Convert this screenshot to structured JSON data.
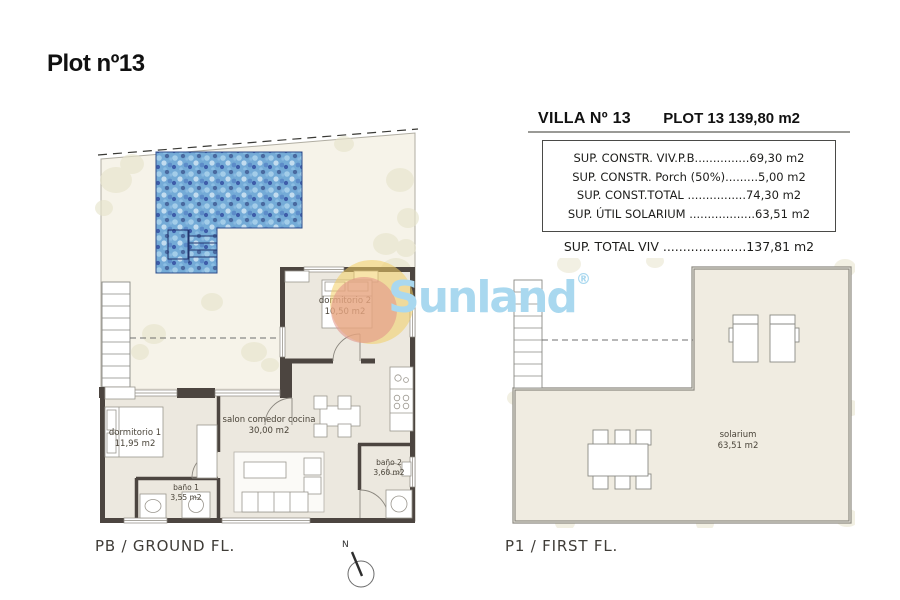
{
  "page": {
    "title": "Plot nº13"
  },
  "watermark": {
    "brand": "Sunland",
    "registered_mark": "®"
  },
  "spec_table": {
    "title_left": "VILLA Nº 13",
    "title_right": "PLOT 13 139,80 m2",
    "rows": [
      "SUP. CONSTR. VIV.P.B...............69,30 m2",
      "SUP. CONSTR. Porch (50%).........5,00 m2",
      "SUP. CONST.TOTAL ................74,30 m2",
      "SUP. ÚTIL SOLARIUM ..................63,51 m2"
    ],
    "total_row": "SUP. TOTAL VIV .....................137,81 m2"
  },
  "ground_floor": {
    "caption": "PB / GROUND FL.",
    "rooms": {
      "dormitorio2": {
        "name": "dormitorio 2",
        "area": "10,50 m2"
      },
      "dormitorio1": {
        "name": "dormitorio 1",
        "area": "11,95 m2"
      },
      "salon": {
        "name": "salon comedor cocina",
        "area": "30,00 m2"
      },
      "bano1": {
        "name": "baño 1",
        "area": "3,55 m2"
      },
      "bano2": {
        "name": "baño 2",
        "area": "3,60 m2"
      }
    }
  },
  "first_floor": {
    "caption": "P1 / FIRST FL.",
    "rooms": {
      "solarium": {
        "name": "solarium",
        "area": "63,51 m2"
      }
    }
  },
  "compass": {
    "north_label": "N"
  },
  "colors": {
    "pool_blue": "#74abd7",
    "wall_dark": "#4c4540",
    "plan_cream": "#f6f3e9",
    "watermark_blue": "#a9d8ef",
    "sun_yellow": "#f2cd64",
    "sun_pink": "#e2968c"
  }
}
